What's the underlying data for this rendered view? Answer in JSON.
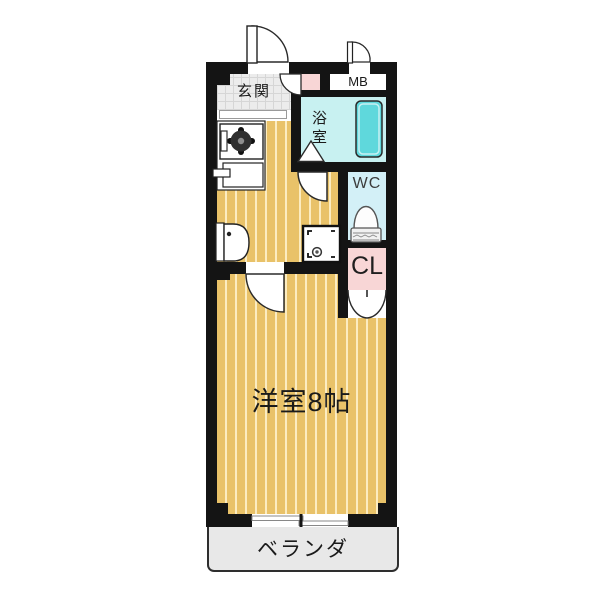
{
  "plan_title": "1K apartment floor plan",
  "labels": {
    "genkan": "玄関",
    "mb": "MB",
    "bathroom": "浴室",
    "wc": "WC",
    "closet": "CL",
    "main_room": "洋室8帖",
    "veranda": "ベランダ"
  },
  "colors": {
    "wall": "#141414",
    "wood_floor": "#e9c269",
    "wood_floor_stripe": "#fff4d0",
    "entrance_tile": "#ececec",
    "bathroom": "#c8f1f1",
    "bathtub": "#5fd8dc",
    "wc": "#d3f0f7",
    "closet_pink": "#f8d6d6",
    "veranda": "#e8e8e8"
  }
}
